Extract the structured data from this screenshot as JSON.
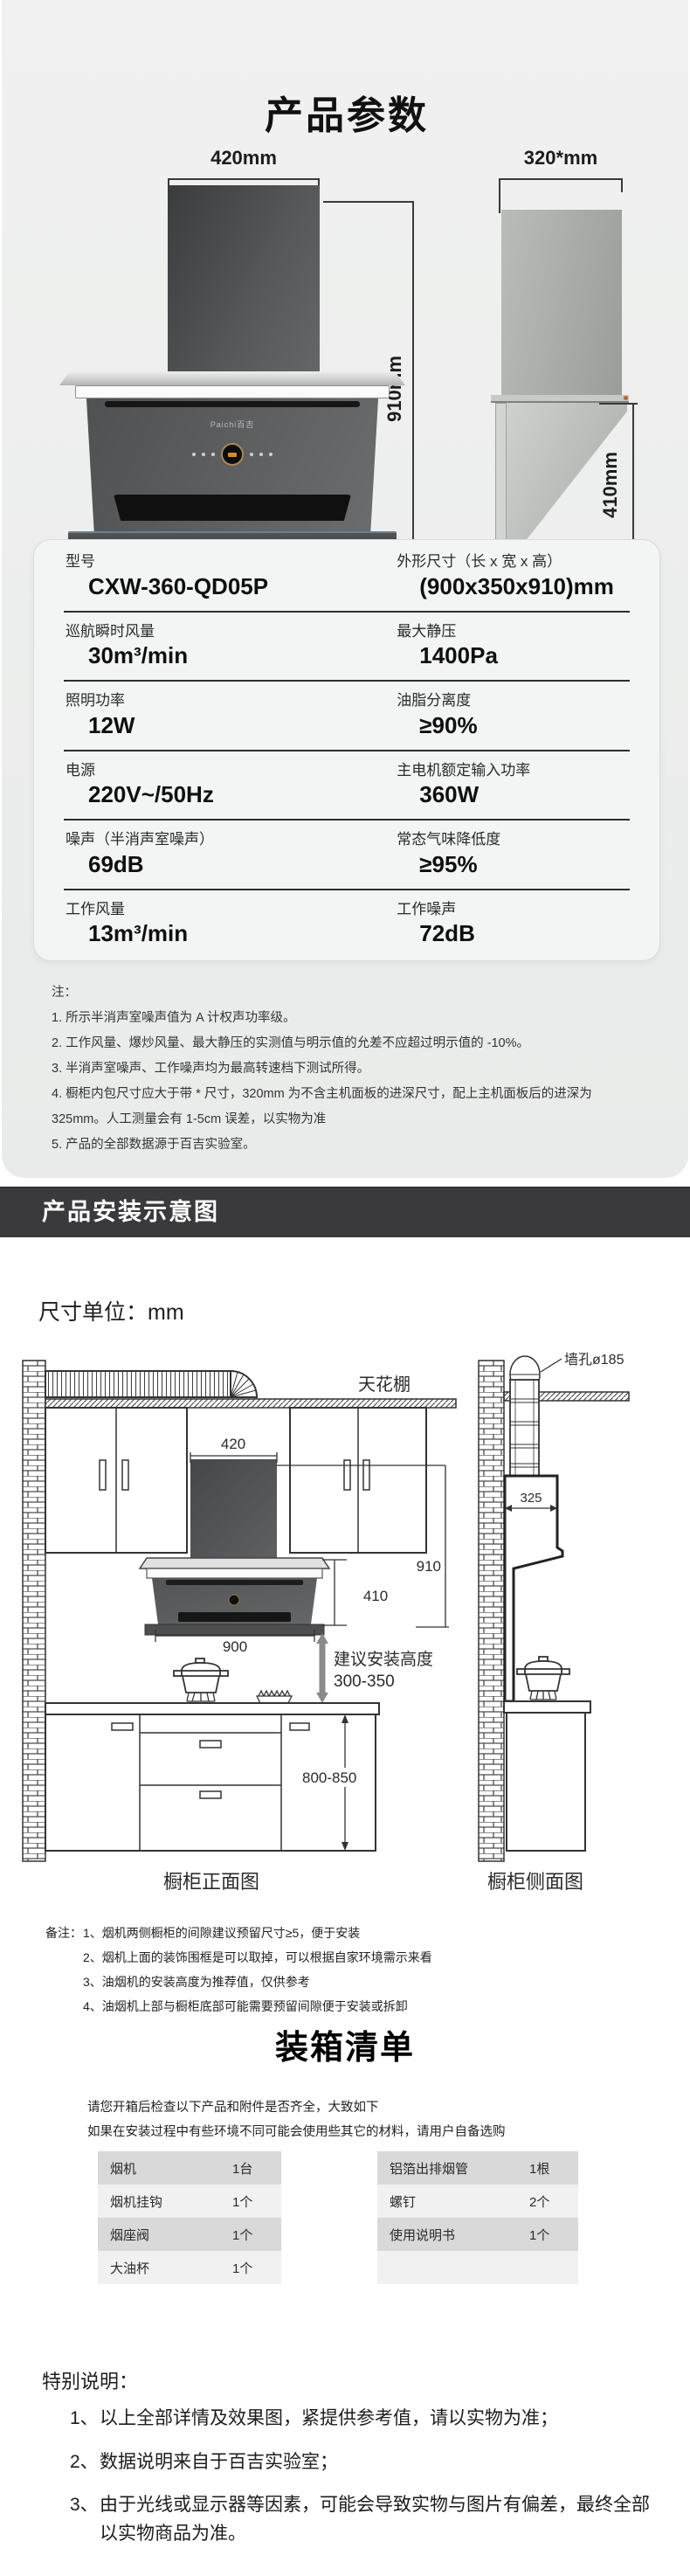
{
  "header": {
    "title": "产品参数"
  },
  "product_photo": {
    "front": {
      "width_label": "420mm",
      "height_label": "910mm",
      "bottom_label": "900mm",
      "brand": "Paichi百吉"
    },
    "side": {
      "width_label": "320*mm",
      "height_label": "410mm",
      "bottom_label": "350mm"
    }
  },
  "spec_table": {
    "rows": [
      {
        "c1": {
          "label": "型号",
          "value": "CXW-360-QD05P"
        },
        "c2": {
          "label": "外形尺寸（长 x 宽 x 高）",
          "value": "(900x350x910)mm"
        }
      },
      {
        "c1": {
          "label": "巡航瞬时风量",
          "value": "30m³/min"
        },
        "c2": {
          "label": "最大静压",
          "value": "1400Pa"
        }
      },
      {
        "c1": {
          "label": "照明功率",
          "value": "12W"
        },
        "c2": {
          "label": "油脂分离度",
          "value": "≥90%"
        }
      },
      {
        "c1": {
          "label": "电源",
          "value": "220V~/50Hz"
        },
        "c2": {
          "label": "主电机额定输入功率",
          "value": "360W"
        }
      },
      {
        "c1": {
          "label": "噪声（半消声室噪声）",
          "value": "69dB"
        },
        "c2": {
          "label": "常态气味降低度",
          "value": "≥95%"
        }
      },
      {
        "c1": {
          "label": "工作风量",
          "value": "13m³/min"
        },
        "c2": {
          "label": "工作噪声",
          "value": "72dB"
        }
      }
    ]
  },
  "notes": {
    "title": "注：",
    "items": [
      "1. 所示半消声室噪声值为 A 计权声功率级。",
      "2. 工作风量、爆炒风量、最大静压的实测值与明示值的允差不应超过明示值的 -10%。",
      "3. 半消声室噪声、工作噪声均为最高转速档下测试所得。",
      "4. 橱柜内包尺寸应大于带 * 尺寸，320mm 为不含主机面板的进深尺寸，配上主机面板后的进深为 325mm。人工测量会有 1-5cm 误差，以实物为准",
      "5. 产品的全部数据源于百吉实验室。"
    ]
  },
  "install": {
    "banner": "产品安装示意图",
    "unit_label": "尺寸单位：mm",
    "front_diagram": {
      "ceiling": "天花棚",
      "dim_width": "420",
      "dim_total_height": "910",
      "dim_hood_height": "410",
      "dim_hood_width": "900",
      "install_height_label": "建议安装高度",
      "install_height_range": "300-350",
      "counter_height": "800-850",
      "caption": "橱柜正面图"
    },
    "side_diagram": {
      "wall_hole": "墙孔ø185",
      "dim_depth": "325",
      "caption": "橱柜侧面图"
    },
    "remarks_label": "备注：",
    "remarks": [
      "1、烟机两侧橱柜的间隙建议预留尺寸≥5，便于安装",
      "2、烟机上面的装饰围框是可以取掉，可以根据自家环境需示来看",
      "3、油烟机的安装高度为推荐值，仅供参考",
      "4、油烟机上部与橱柜底部可能需要预留间隙便于安装或拆卸"
    ]
  },
  "packing": {
    "title": "装箱清单",
    "intro1": "请您开箱后检查以下产品和附件是否齐全，大致如下",
    "intro2": "如果在安装过程中有些环境不同可能会使用些其它的材料，请用户自备选购",
    "left_items": [
      {
        "name": "烟机",
        "qty": "1台"
      },
      {
        "name": "烟机挂钩",
        "qty": "1个"
      },
      {
        "name": "烟座阀",
        "qty": "1个"
      },
      {
        "name": "大油杯",
        "qty": "1个"
      }
    ],
    "right_items": [
      {
        "name": "铝箔出排烟管",
        "qty": "1根"
      },
      {
        "name": "螺钉",
        "qty": "2个"
      },
      {
        "name": "使用说明书",
        "qty": "1个"
      },
      {
        "name": "",
        "qty": ""
      }
    ]
  },
  "special": {
    "title": "特别说明：",
    "items": [
      {
        "num": "1、",
        "text": "以上全部详情及效果图，紧提供参考值，请以实物为准；"
      },
      {
        "num": "2、",
        "text": "数据说明来自于百吉实验室；"
      },
      {
        "num": "3、",
        "text": "由于光线或显示器等因素，可能会导致实物与图片有偏差，最终全部以实物商品为准。"
      }
    ]
  }
}
